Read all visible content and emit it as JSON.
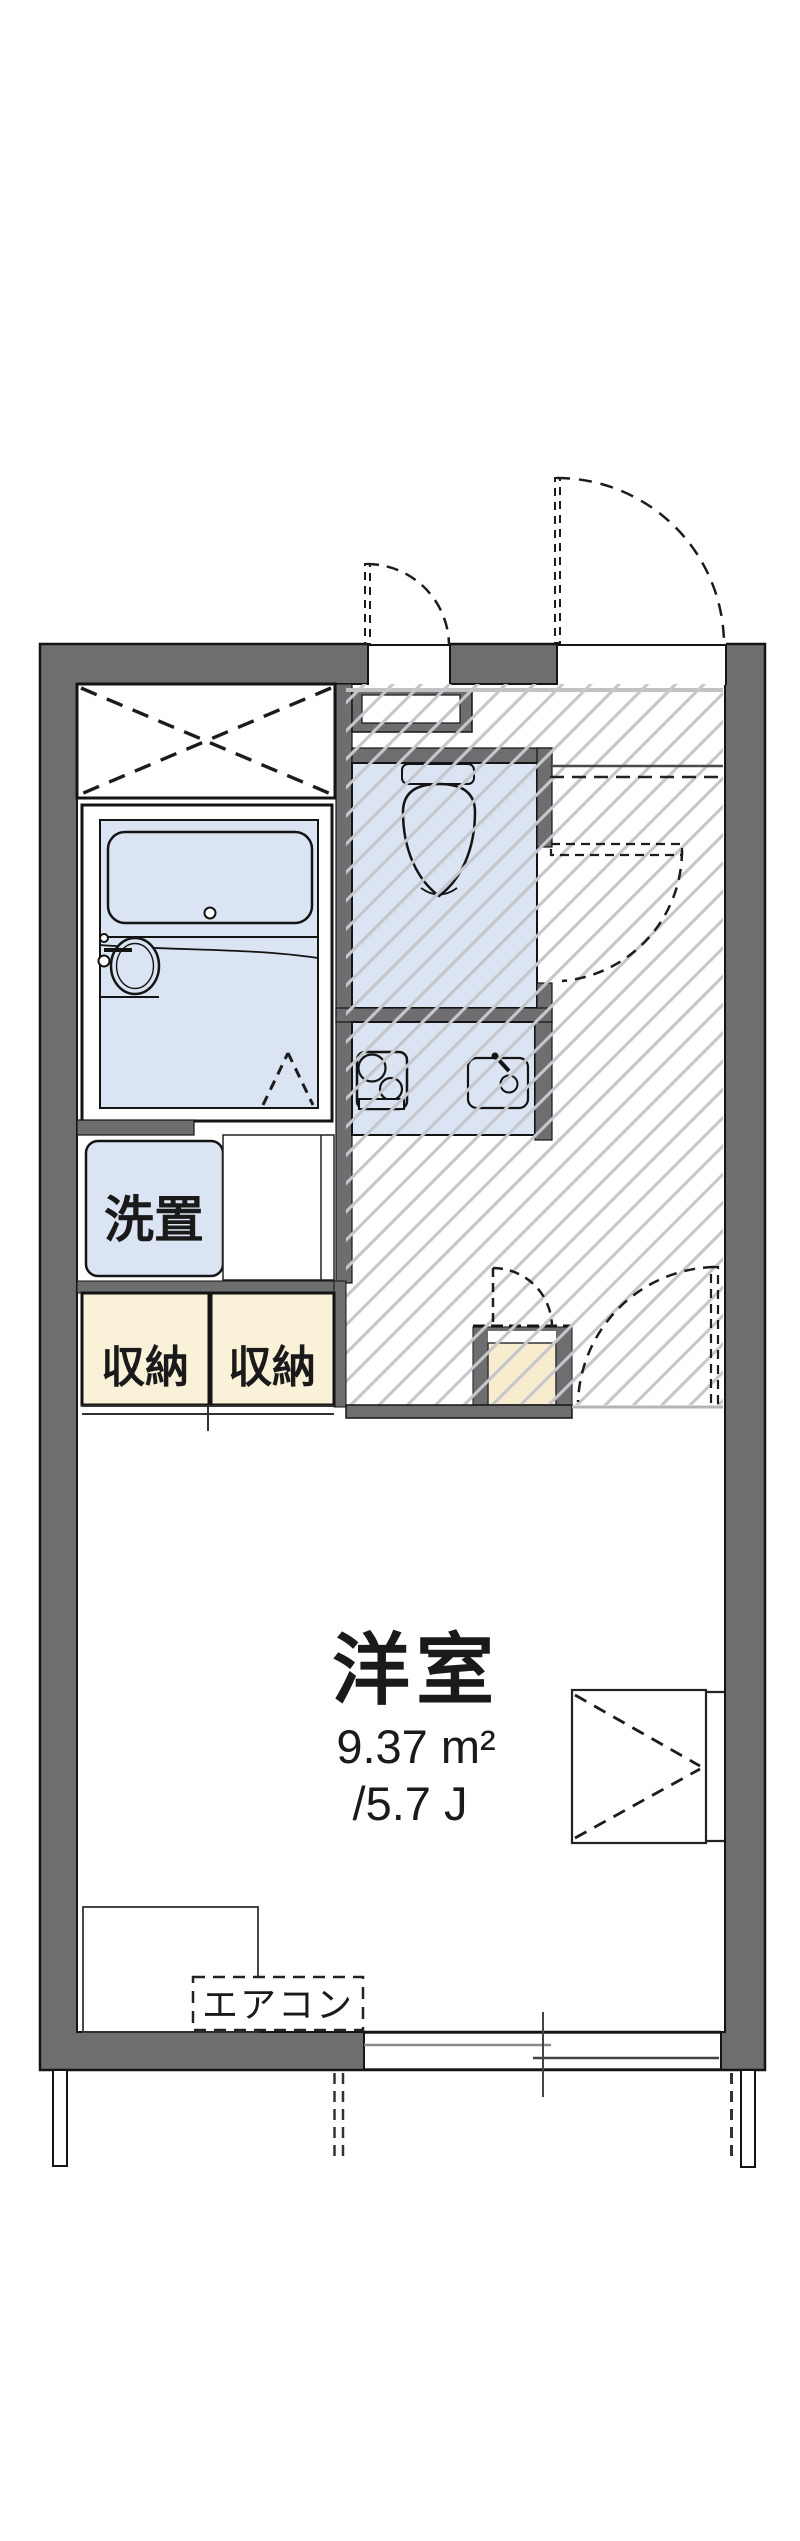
{
  "plan": {
    "type": "apartment-floor-plan",
    "labels": {
      "main_room_name": "洋室",
      "main_room_area_m2": "9.37 m²",
      "main_room_area_tatami": "/5.7 J",
      "storage_left": "収納",
      "storage_right": "収納",
      "laundry_space": "洗置",
      "air_conditioner": "エアコン"
    },
    "rooms": [
      {
        "name": "洋室",
        "area_m2": 9.37,
        "area_tatami": 5.7
      },
      {
        "name": "収納",
        "count": 2
      },
      {
        "name": "洗置"
      },
      {
        "name": "unit-bath"
      },
      {
        "name": "toilet"
      },
      {
        "name": "kitchen"
      },
      {
        "name": "hallway-hatched"
      }
    ],
    "colors": {
      "wall_gray": "#6e6e71",
      "line_black": "#141414",
      "water_area_blue": "#dbe4f2",
      "storage_cream": "#f9f1d8",
      "shoe_cabinet_beige": "#f8ecce",
      "hatch_line_gray": "#c5c7cc",
      "step_line_gray": "#c2c2c2",
      "background": "#ffffff"
    }
  }
}
